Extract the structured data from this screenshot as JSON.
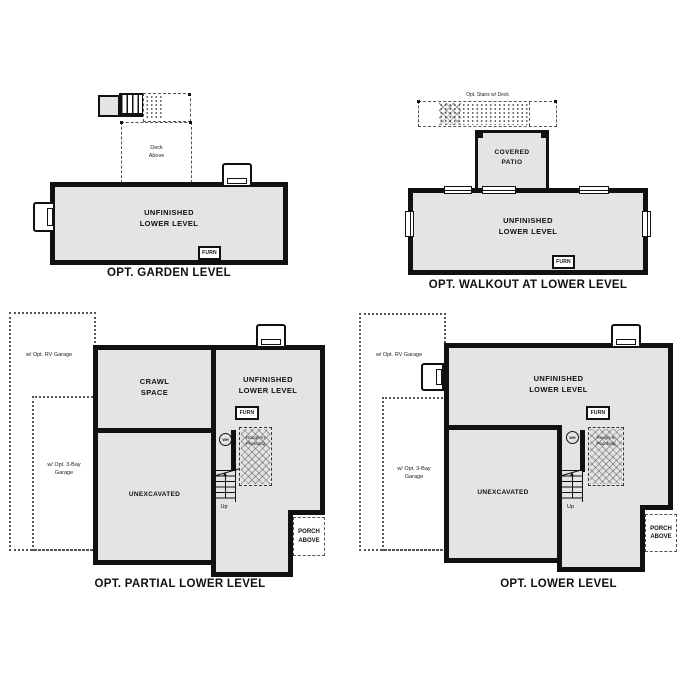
{
  "colors": {
    "wall": "#111111",
    "room_fill": "#e4e4e4",
    "background": "#ffffff"
  },
  "plans": {
    "garden": {
      "title": "OPT. GARDEN LEVEL",
      "room": "UNFINISHED\nLOWER LEVEL",
      "deck": "Deck\nAbove",
      "furnace": "FURN"
    },
    "walkout": {
      "title": "OPT. WALKOUT AT LOWER LEVEL",
      "room": "UNFINISHED\nLOWER LEVEL",
      "patio": "COVERED\nPATIO",
      "deck_label": "Opt. Stairs w/ Deck",
      "furnace": "FURN"
    },
    "partial": {
      "title": "OPT. PARTIAL LOWER LEVEL",
      "crawl": "CRAWL\nSPACE",
      "room": "UNFINISHED\nLOWER LEVEL",
      "unexcavated": "UNEXCAVATED",
      "furnace": "FURN",
      "water_heater": "WH",
      "rough_in": "Rough-In\nPlumbing",
      "up": "Up",
      "porch": "PORCH\nABOVE",
      "rv_garage": "w/ Opt. RV Garage",
      "three_bay_garage": "w/ Opt. 3-Bay\nGarage"
    },
    "lower": {
      "title": "OPT. LOWER LEVEL",
      "room": "UNFINISHED\nLOWER LEVEL",
      "unexcavated": "UNEXCAVATED",
      "furnace": "FURN",
      "water_heater": "WH",
      "rough_in": "Rough-In\nPlumbing",
      "up": "Up",
      "porch": "PORCH\nABOVE",
      "rv_garage": "w/ Opt. RV Garage",
      "three_bay_garage": "w/ Opt. 3-Bay\nGarage"
    }
  }
}
